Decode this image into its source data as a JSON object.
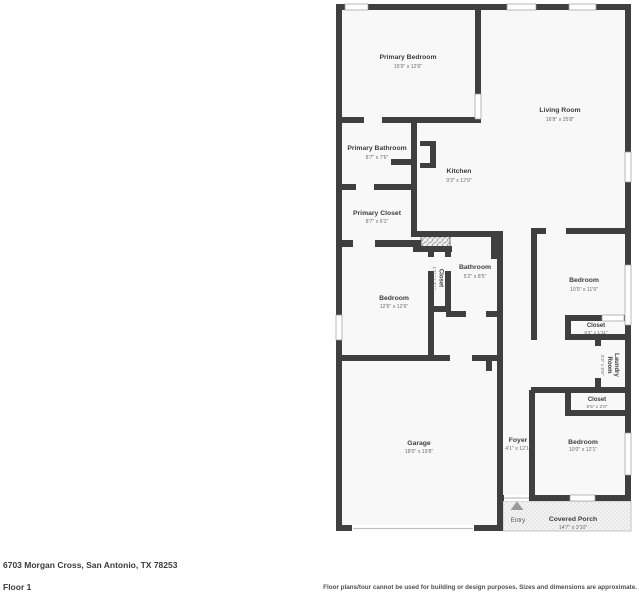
{
  "floorplan": {
    "rooms": {
      "primary_bedroom": {
        "name": "Primary Bedroom",
        "dims": "15'9\" x 12'6\""
      },
      "living_room": {
        "name": "Living Room",
        "dims": "16'8\" x 25'8\""
      },
      "primary_bathroom": {
        "name": "Primary Bathroom",
        "dims": "8'7\" x 7'6\""
      },
      "kitchen": {
        "name": "Kitchen",
        "dims": "9'3\" x 12'9\""
      },
      "primary_closet": {
        "name": "Primary Closet",
        "dims": "8'7\" x 6'1\""
      },
      "bedroom_mid": {
        "name": "Bedroom",
        "dims": "12'6\" x 12'6\""
      },
      "closet_mid": {
        "name": "Closet",
        "dims": "1'11\" x 7'1\""
      },
      "bathroom": {
        "name": "Bathroom",
        "dims": "5'2\" x 8'5\""
      },
      "bedroom_right": {
        "name": "Bedroom",
        "dims": "10'0\" x 11'9\""
      },
      "closet_right": {
        "name": "Closet",
        "dims": "6'4\" x 1'11\""
      },
      "laundry": {
        "name_line1": "Laundry",
        "name_line2": "Room",
        "dims": "3'3\" x 5'6\""
      },
      "closet_hall": {
        "name": "Closet",
        "dims": "6'5\" x 2'0\""
      },
      "bedroom_front": {
        "name": "Bedroom",
        "dims": "10'0\" x 12'1\""
      },
      "foyer": {
        "name": "Foyer",
        "dims": "4'1\" x 12'1\""
      },
      "garage": {
        "name": "Garage",
        "dims": "18'0\" x 19'8\""
      },
      "entry": {
        "name": "Entry"
      },
      "covered_porch": {
        "name": "Covered Porch",
        "dims": "14'7\" x 3'10\""
      }
    },
    "footer": {
      "address": "6703 Morgan Cross, San Antonio, TX 78253",
      "floor": "Floor 1",
      "disclaimer": "Floor plans/tour cannot be used for building or design purposes. Sizes and dimensions are approximate."
    },
    "colors": {
      "wall": "#3f3f3f",
      "room_fill": "#f8f8f8",
      "window_stroke": "#9b9b9b"
    }
  }
}
